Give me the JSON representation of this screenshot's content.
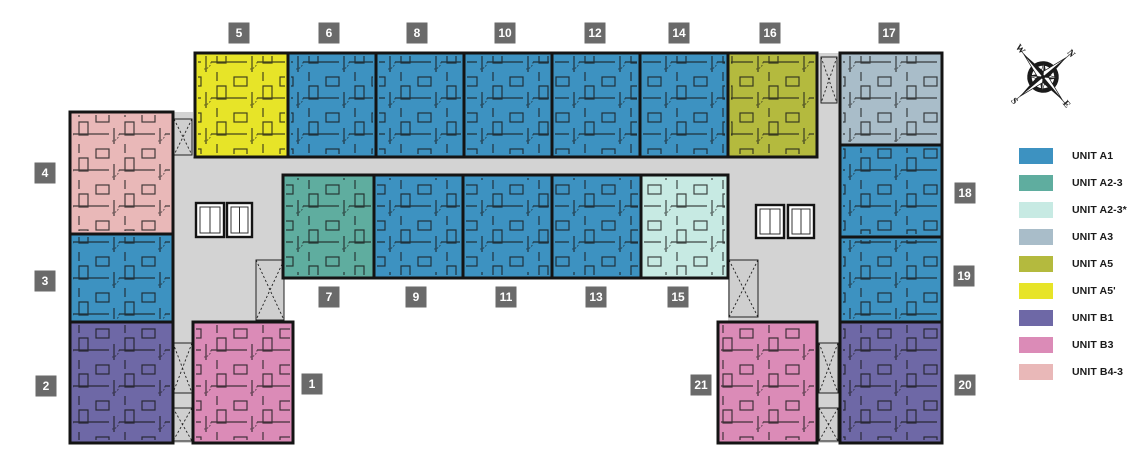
{
  "legend": {
    "items": [
      {
        "key": "A1",
        "label": "UNIT A1",
        "color": "#3D92C1"
      },
      {
        "key": "A2-3",
        "label": "UNIT A2-3",
        "color": "#5FAD9F"
      },
      {
        "key": "A2-3*",
        "label": "UNIT A2-3*",
        "color": "#C7EAE3"
      },
      {
        "key": "A3",
        "label": "UNIT A3",
        "color": "#A9BDC9"
      },
      {
        "key": "A5",
        "label": "UNIT A5",
        "color": "#B4BA3E"
      },
      {
        "key": "A5'",
        "label": "UNIT A5'",
        "color": "#E7E428"
      },
      {
        "key": "B1",
        "label": "UNIT B1",
        "color": "#6E68A6"
      },
      {
        "key": "B3",
        "label": "UNIT B3",
        "color": "#DB8BB7"
      },
      {
        "key": "B4-3",
        "label": "UNIT B4-3",
        "color": "#E9B8B8"
      }
    ]
  },
  "compass": {
    "points": [
      "N",
      "E",
      "S",
      "W"
    ],
    "rotation_deg": 50
  },
  "floor_plan": {
    "wall_color": "#141414",
    "corridor_color": "#D3D3D3",
    "badge_color": "#6A6A6A",
    "badge_text_color": "#FFFFFF",
    "units": [
      {
        "number": "1",
        "type": "B3",
        "rect": [
          193,
          322,
          100,
          121
        ],
        "badge": [
          312,
          384
        ]
      },
      {
        "number": "2",
        "type": "B1",
        "rect": [
          70,
          322,
          103,
          121
        ],
        "badge": [
          46,
          386
        ]
      },
      {
        "number": "3",
        "type": "A1",
        "rect": [
          70,
          234,
          103,
          88
        ],
        "badge": [
          45,
          281
        ]
      },
      {
        "number": "4",
        "type": "B4-3",
        "rect": [
          70,
          112,
          103,
          122
        ],
        "badge": [
          45,
          173
        ]
      },
      {
        "number": "5",
        "type": "A5'",
        "rect": [
          195,
          53,
          93,
          104
        ],
        "badge": [
          239,
          33
        ]
      },
      {
        "number": "6",
        "type": "A1",
        "rect": [
          288,
          53,
          88,
          104
        ],
        "badge": [
          329,
          33
        ]
      },
      {
        "number": "7",
        "type": "A2-3",
        "rect": [
          283,
          175,
          91,
          103
        ],
        "badge": [
          329,
          297
        ]
      },
      {
        "number": "8",
        "type": "A1",
        "rect": [
          376,
          53,
          88,
          104
        ],
        "badge": [
          417,
          33
        ]
      },
      {
        "number": "9",
        "type": "A1",
        "rect": [
          374,
          175,
          89,
          103
        ],
        "badge": [
          416,
          297
        ]
      },
      {
        "number": "10",
        "type": "A1",
        "rect": [
          464,
          53,
          88,
          104
        ],
        "badge": [
          505,
          33
        ]
      },
      {
        "number": "11",
        "type": "A1",
        "rect": [
          463,
          175,
          89,
          103
        ],
        "badge": [
          506,
          297
        ]
      },
      {
        "number": "12",
        "type": "A1",
        "rect": [
          552,
          53,
          88,
          104
        ],
        "badge": [
          595,
          33
        ]
      },
      {
        "number": "13",
        "type": "A1",
        "rect": [
          552,
          175,
          89,
          103
        ],
        "badge": [
          596,
          297
        ]
      },
      {
        "number": "14",
        "type": "A1",
        "rect": [
          640,
          53,
          88,
          104
        ],
        "badge": [
          679,
          33
        ]
      },
      {
        "number": "15",
        "type": "A2-3*",
        "rect": [
          641,
          175,
          87,
          103
        ],
        "badge": [
          678,
          297
        ]
      },
      {
        "number": "16",
        "type": "A5",
        "rect": [
          728,
          53,
          89,
          104
        ],
        "badge": [
          770,
          33
        ]
      },
      {
        "number": "17",
        "type": "A3",
        "rect": [
          840,
          53,
          102,
          92
        ],
        "badge": [
          889,
          33
        ]
      },
      {
        "number": "18",
        "type": "A1",
        "rect": [
          840,
          145,
          102,
          92
        ],
        "badge": [
          965,
          193
        ]
      },
      {
        "number": "19",
        "type": "A1",
        "rect": [
          840,
          237,
          102,
          85
        ],
        "badge": [
          964,
          276
        ]
      },
      {
        "number": "20",
        "type": "B1",
        "rect": [
          840,
          322,
          102,
          121
        ],
        "badge": [
          965,
          385
        ]
      },
      {
        "number": "21",
        "type": "B3",
        "rect": [
          718,
          322,
          99,
          121
        ],
        "badge": [
          701,
          385
        ]
      }
    ],
    "corridors": [
      [
        171,
        112,
        22,
        331
      ],
      [
        193,
        157,
        647,
        21
      ],
      [
        817,
        53,
        23,
        390
      ],
      [
        193,
        178,
        90,
        144
      ],
      [
        728,
        178,
        89,
        144
      ],
      [
        171,
        322,
        22,
        121
      ],
      [
        817,
        322,
        23,
        121
      ]
    ],
    "elevators": [
      [
        196,
        203,
        28,
        34
      ],
      [
        227,
        203,
        25,
        34
      ],
      [
        756,
        205,
        28,
        33
      ],
      [
        788,
        205,
        26,
        33
      ]
    ],
    "stairs": [
      [
        256,
        260,
        28,
        60
      ],
      [
        729,
        260,
        29,
        57
      ],
      [
        174,
        119,
        18,
        36
      ],
      [
        821,
        57,
        16,
        46
      ],
      [
        173,
        343,
        19,
        50
      ],
      [
        173,
        408,
        19,
        33
      ],
      [
        819,
        343,
        19,
        50
      ],
      [
        819,
        408,
        19,
        33
      ]
    ]
  }
}
